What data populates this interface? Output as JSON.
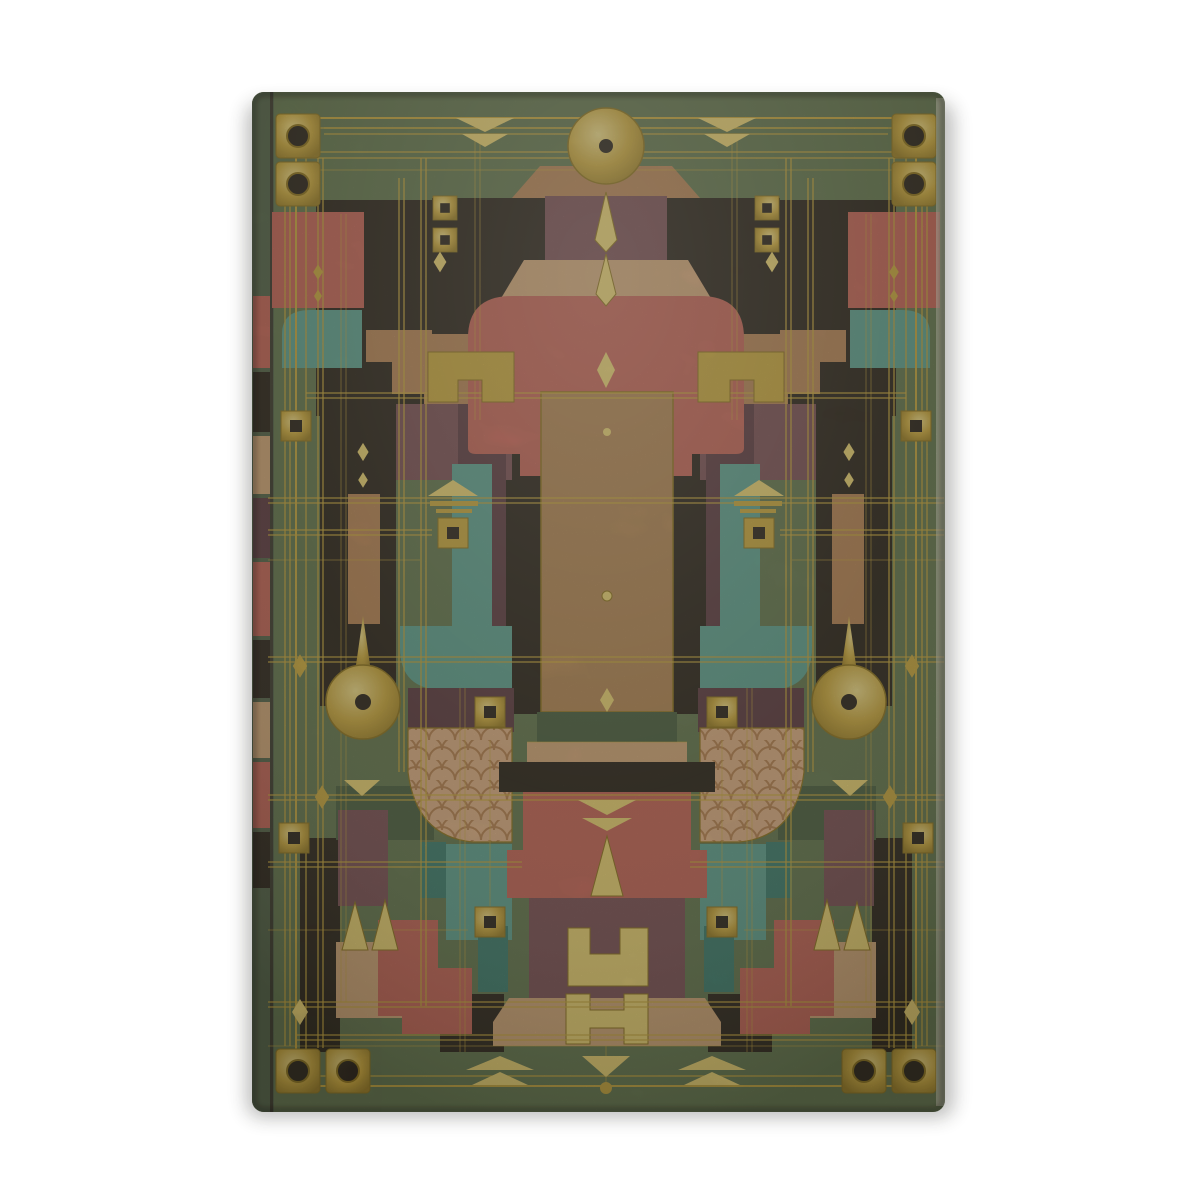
{
  "meta": {
    "type": "product-photograph",
    "description": "Hardcover journal photographed upright on a plain white background. The front cover is a symmetrical Art Deco geometric inlay: mottled green leather with gilt tooling lines, gold corner studs, a central bronze panel, salmon-red arches, plum and copper columns, teal brackets, fish-scale copper fans, gold keyhole medallions and chevron borders.",
    "background": "#ffffff"
  },
  "book": {
    "kind": "hardcover journal",
    "orientation": "portrait",
    "cover_style": "Art Deco / Prairie-style geometric inlay",
    "texture": "mottled leather with gilt tooling",
    "spine_side": "left",
    "spine_blocks": [
      "salmon",
      "near-black",
      "light-copper",
      "dark-maroon",
      "salmon",
      "near-black",
      "light-copper",
      "salmon",
      "near-black"
    ]
  },
  "palette": {
    "cover_green": "#64734f",
    "cover_green_dark": "#4c5c41",
    "gold": "#c7a33e",
    "gold_light": "#e6cb72",
    "gold_dark": "#8e7120",
    "bronze_panel": "#b08254",
    "copper": "#b58056",
    "copper_light": "#cfa077",
    "salmon": "#c26257",
    "salmon_deep": "#ab4f46",
    "plum": "#7b4e55",
    "maroon_dark": "#5e3a42",
    "near_black": "#2e241d",
    "teal": "#5f9c8e",
    "teal_dark": "#3f7a6e",
    "scale_fill": "#d9aa82",
    "scale_line": "#b37c50",
    "spine_base": "#55624a",
    "fore_edge": "#d8d4c4",
    "shadow": "#2a2a26"
  },
  "ornaments": [
    {
      "name": "disc-medallion",
      "desc": "large gold disc with dark center hole, top center of cover"
    },
    {
      "name": "keyhole-medallion",
      "desc": "gold disc with pointed stem and dark hole, one on each side at mid height"
    },
    {
      "name": "corner-stud",
      "desc": "gold square with dark circular hole, two per corner"
    },
    {
      "name": "square-ring",
      "desc": "small gold square ring with dark center, scattered on columns"
    },
    {
      "name": "chevron-border",
      "desc": "stacked gold arrowheads on top and bottom borders"
    },
    {
      "name": "fish-scale-fan",
      "desc": "copper fan filled with overlapping scallop scales beside center"
    },
    {
      "name": "diamond-finial",
      "desc": "elongated gold double diamond below the top disc"
    },
    {
      "name": "meander-bracket",
      "desc": "gold squared hook bracket flanking the central arch"
    },
    {
      "name": "lantern-ornament",
      "desc": "gold chevron roof with bars and square ring on side columns"
    },
    {
      "name": "tree-triangles",
      "desc": "pair of tall gold triangles in lower quadrants"
    },
    {
      "name": "h-motif",
      "desc": "interlocking gold squared H brackets at bottom center"
    },
    {
      "name": "bottom-drop",
      "desc": "gold triangle with pendant dot at bottom center border"
    },
    {
      "name": "grid-lines",
      "desc": "thin double gilt tooling lines crossing the whole cover"
    }
  ]
}
